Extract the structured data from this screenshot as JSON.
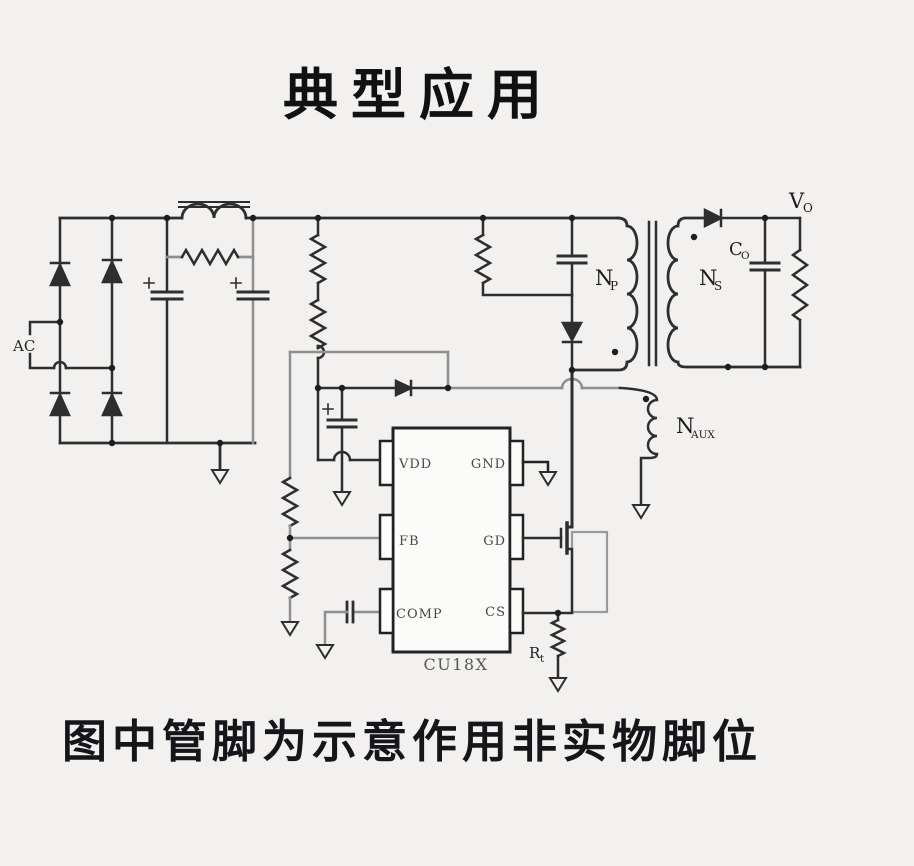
{
  "title": "典型应用",
  "caption": "图中管脚为示意作用非实物脚位",
  "labels": {
    "ac": "AC",
    "primary": {
      "main": "N",
      "sub": "P"
    },
    "secondary": {
      "main": "N",
      "sub": "S"
    },
    "aux": {
      "main": "N",
      "sub": "AUX"
    },
    "vout": {
      "main": "V",
      "sub": "O"
    },
    "cout": {
      "main": "C",
      "sub": "O"
    },
    "rsense": {
      "main": "R",
      "sub": "t"
    }
  },
  "ic": {
    "name": "CU18X",
    "pins": {
      "vdd": "VDD",
      "gnd": "GND",
      "fb": "FB",
      "gd": "GD",
      "comp": "COMP",
      "cs": "CS"
    }
  },
  "colors": {
    "background": "#f2f1ef",
    "wire": "#2e2e2e",
    "wire_gray": "#8f8f8f",
    "ink": "#141414"
  }
}
